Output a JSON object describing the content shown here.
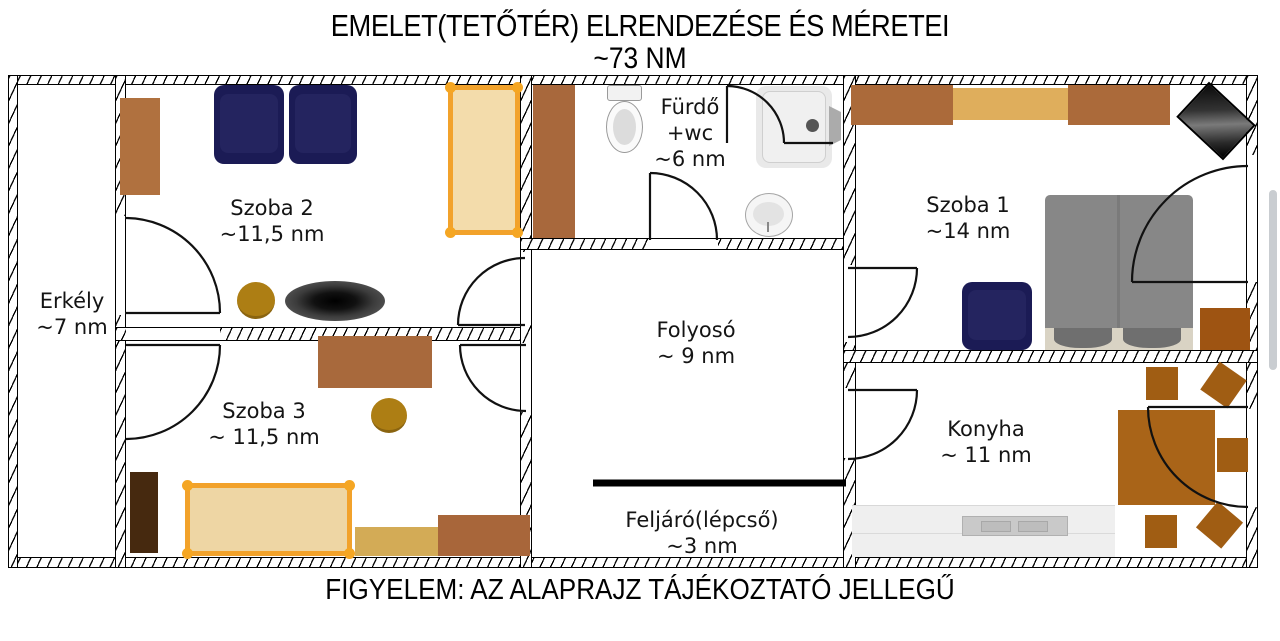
{
  "title": {
    "line1": "EMELET(TETŐTÉR) ELRENDEZÉSE ÉS MÉRETEI",
    "line2": "~73 NM"
  },
  "footer": {
    "warning": "FIGYELEM: AZ ALAPRAJZ TÁJÉKOZTATÓ JELLEGŰ"
  },
  "rooms": {
    "erkely": {
      "name": "Erkély",
      "area": "~7 nm"
    },
    "szoba2": {
      "name": "Szoba 2",
      "area": "~11,5 nm"
    },
    "szoba3": {
      "name": "Szoba 3",
      "area": "~ 11,5 nm"
    },
    "furdo": {
      "name": "Fürdő",
      "extra": "+wc",
      "area": "~6 nm"
    },
    "folyoso": {
      "name": "Folyosó",
      "area": "~ 9 nm"
    },
    "szoba1": {
      "name": "Szoba 1",
      "area": "~14 nm"
    },
    "konyha": {
      "name": "Konyha",
      "area": "~ 11 nm"
    },
    "feljaro": {
      "name": "Feljáró(lépcső)",
      "area": "~3 nm"
    }
  },
  "colors": {
    "wall_line": "#000000",
    "wood_brown": "#ab6a3a",
    "dark_wood": "#46290f",
    "kitchen_wood": "#a96418",
    "navy_chair": "#1b1b55",
    "bed_frame_orange": "#f2a22b",
    "bed_fill_tan": "#f3dcab",
    "cabinet_gold": "#dfae5c",
    "bed_gray": "#878787",
    "counter_gray": "#ededed",
    "scrollbar_gray": "#c9cdd1"
  }
}
